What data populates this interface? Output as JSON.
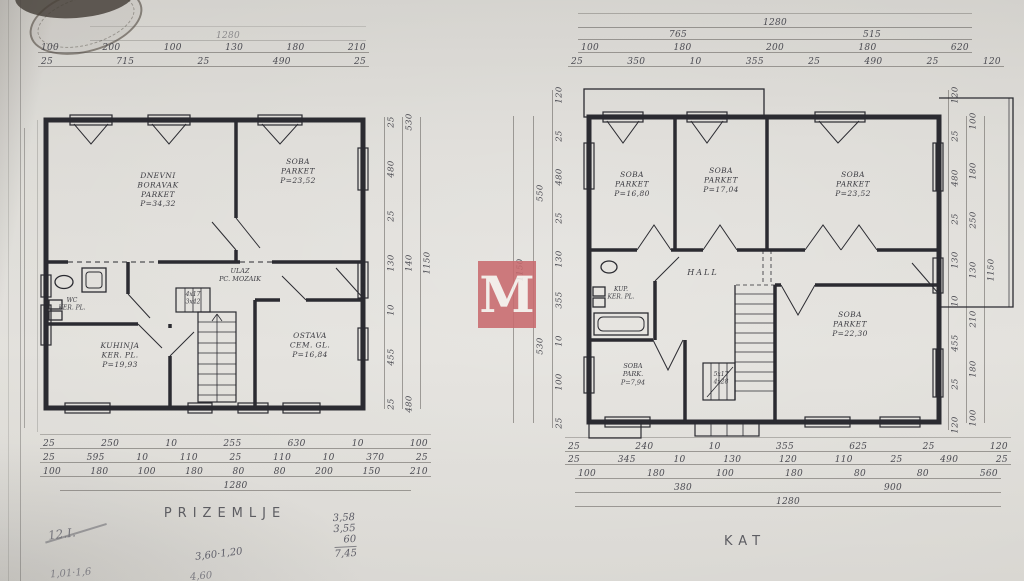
{
  "watermark": {
    "letter": "M",
    "color": "#c96b6f"
  },
  "prizemlje": {
    "title": "PRIZEMLJE",
    "rooms": {
      "living": {
        "lines": [
          "DNEVNI",
          "BORAVAK",
          "PARKET",
          "P=34,32"
        ]
      },
      "soba": {
        "lines": [
          "SOBA",
          "PARKET",
          "P=23,52"
        ]
      },
      "ulaz": {
        "lines": [
          "ULAZ",
          "PC. MOZAIK"
        ]
      },
      "wc": {
        "lines": [
          "WC",
          "KER. PL."
        ]
      },
      "kuhinja": {
        "lines": [
          "KUHINJA",
          "KER. PL.",
          "P=19,93"
        ]
      },
      "ostava": {
        "lines": [
          "OSTAVA",
          "CEM. GL.",
          "P=16,84"
        ]
      },
      "stairs": {
        "lines": [
          "4x17",
          "3x42"
        ]
      }
    },
    "dims": {
      "top": [
        [
          "1280"
        ],
        [
          "100",
          "200",
          "100",
          "130",
          "180",
          "210"
        ],
        [
          "25",
          "715",
          "25",
          "490",
          "25"
        ]
      ],
      "bottom": [
        [
          "25",
          "250",
          "10",
          "255",
          "630",
          "10",
          "100"
        ],
        [
          "25",
          "595",
          "10",
          "110",
          "25",
          "110",
          "10",
          "370",
          "25"
        ],
        [
          "100",
          "180",
          "100",
          "180",
          "80",
          "80",
          "200",
          "150",
          "210"
        ],
        [
          "1280"
        ]
      ],
      "right": [
        [
          "25",
          "480",
          "25",
          "130",
          "10",
          "455",
          "25"
        ],
        [
          "530",
          "140",
          "480"
        ],
        [
          "1150"
        ]
      ]
    }
  },
  "kat": {
    "title": "KAT",
    "rooms": {
      "soba1": {
        "lines": [
          "SOBA",
          "PARKET",
          "P=16,80"
        ]
      },
      "soba2": {
        "lines": [
          "SOBA",
          "PARKET",
          "P=17,04"
        ]
      },
      "soba3": {
        "lines": [
          "SOBA",
          "PARKET",
          "P=23,52"
        ]
      },
      "kupaona": {
        "lines": [
          "KUP.",
          "KER. PL."
        ]
      },
      "hall": {
        "lines": [
          "HALL"
        ]
      },
      "soba4": {
        "lines": [
          "SOBA",
          "PARK.",
          "P=7,94"
        ]
      },
      "soba5": {
        "lines": [
          "SOBA",
          "PARKET",
          "P=22,30"
        ]
      },
      "stairs": {
        "lines": [
          "5x17",
          "4x28"
        ]
      }
    },
    "dims": {
      "top": [
        [
          "1280"
        ],
        [
          "765",
          "515"
        ],
        [
          "100",
          "180",
          "200",
          "180",
          "620"
        ],
        [
          "25",
          "350",
          "10",
          "355",
          "25",
          "490",
          "25",
          "120"
        ]
      ],
      "bottom": [
        [
          "25",
          "240",
          "10",
          "355",
          "625",
          "25",
          "120"
        ],
        [
          "25",
          "345",
          "10",
          "130",
          "120",
          "110",
          "25",
          "490",
          "25"
        ],
        [
          "100",
          "180",
          "100",
          "180",
          "80",
          "80",
          "560"
        ],
        [
          "380",
          "900"
        ],
        [
          "1280"
        ]
      ],
      "left": [
        [
          "120",
          "25",
          "480",
          "25",
          "130",
          "355",
          "10",
          "100",
          "25"
        ],
        [
          "550",
          "530"
        ],
        [
          "1150"
        ]
      ],
      "right": [
        [
          "120",
          "25",
          "480",
          "25",
          "130",
          "10",
          "455",
          "25",
          "120"
        ],
        [
          "100",
          "180",
          "250",
          "130",
          "210",
          "180",
          "100"
        ],
        [
          "1150"
        ]
      ]
    }
  },
  "notes": {
    "scribble": "12.I.",
    "calc_line1": "3,60·1,20",
    "calc_line2": "4,60",
    "partial_left": "1,01·1,6",
    "sum_column": [
      "3,58",
      "3,55",
      "60"
    ],
    "sum_total": "7,45"
  }
}
